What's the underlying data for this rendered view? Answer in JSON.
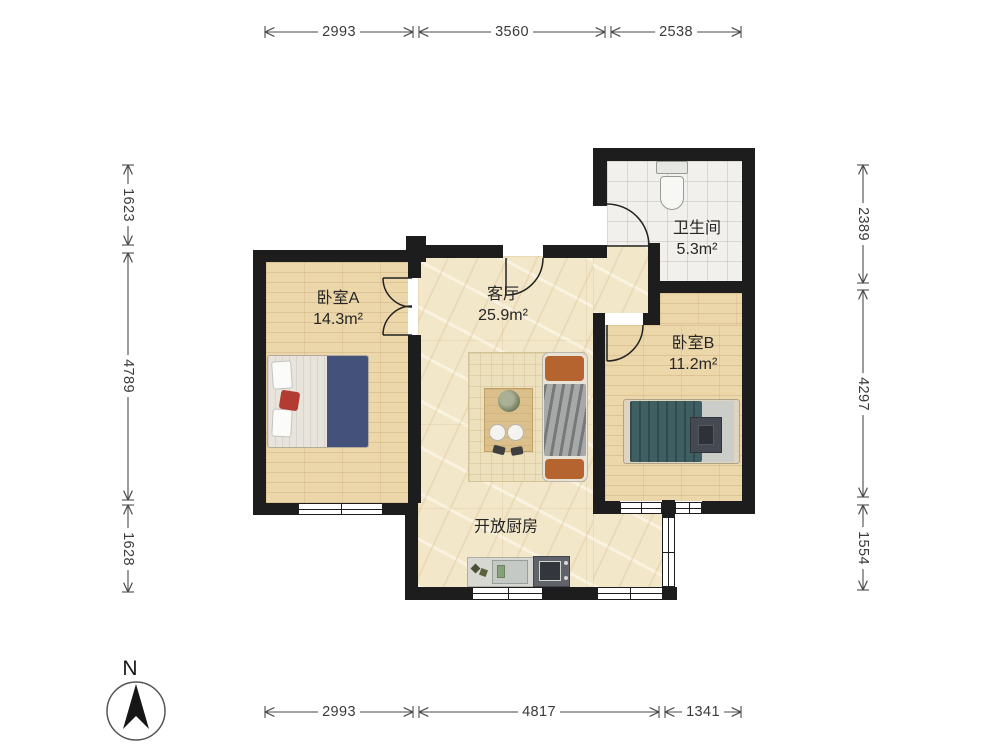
{
  "rooms": {
    "bedroomA": {
      "name": "卧室A",
      "area": "14.3m²"
    },
    "livingRoom": {
      "name": "客厅",
      "area": "25.9m²"
    },
    "bathroom": {
      "name": "卫生间",
      "area": "5.3m²"
    },
    "bedroomB": {
      "name": "卧室B",
      "area": "11.2m²"
    },
    "kitchen": {
      "name": "开放厨房"
    }
  },
  "dimensions": {
    "top": [
      "2993",
      "3560",
      "2538"
    ],
    "bottom": [
      "2993",
      "4817",
      "1341"
    ],
    "left": [
      "1623",
      "4789",
      "1628"
    ],
    "right": [
      "2389",
      "4297",
      "1554"
    ]
  },
  "compass": {
    "north_label": "N"
  },
  "colors": {
    "wall": "#1d1d1d",
    "wood_floor": "#ecd7ab",
    "marble_floor": "#f3e7c9",
    "tile_floor": "#f1f0ec",
    "dimension_text": "#3a3a3a",
    "sofa_cushion": "#b5642f",
    "bed_a_duvet": "#44517b",
    "bed_b_duvet": "#3f5f63"
  }
}
